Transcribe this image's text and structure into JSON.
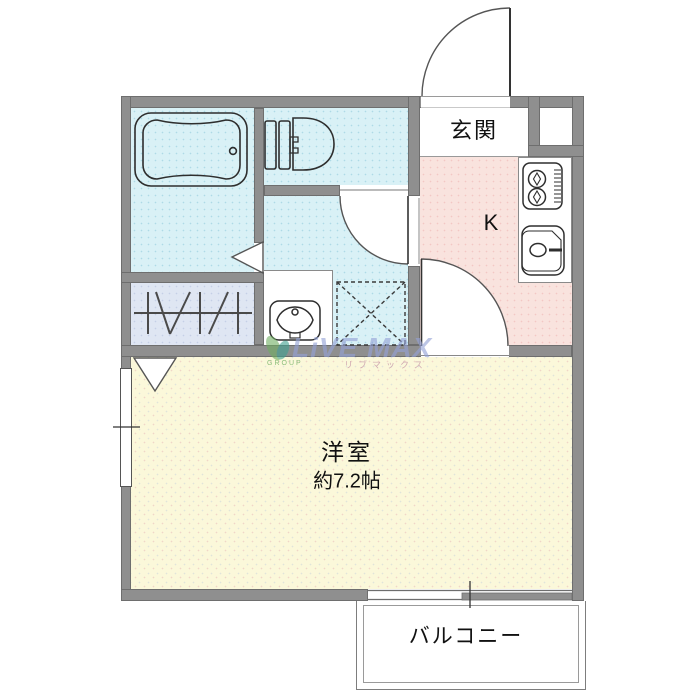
{
  "rooms": {
    "genkan": {
      "label": "玄関"
    },
    "kitchen": {
      "label": "K"
    },
    "western_room": {
      "label": "洋室",
      "area": "約7.2帖"
    },
    "balcony": {
      "label": "バルコニー"
    }
  },
  "watermark": {
    "brand": "LiVE MAX",
    "group_label": "GROUP",
    "katakana": "リブマックス",
    "logo": "leaf-logo"
  },
  "fixtures": {
    "bathtub": "bathtub-icon",
    "toilet": "toilet-icon",
    "stove": "stove-icon",
    "kitchen_sink": "kitchen-sink-icon",
    "washbasin": "washbasin-icon",
    "washing_machine_space": "washing-machine-space",
    "closet_hanger": "closet-hanger-icon",
    "window": "window-symbol",
    "sliding_door": "sliding-window-symbol",
    "doors": [
      "entrance-door-arc",
      "washroom-door-arc",
      "kitchen-door-arc",
      "bath-door-triangle",
      "closet-door-triangle"
    ]
  },
  "colors": {
    "wall": "#8f8f8f",
    "wet_area": "#d9f1f6",
    "closet": "#dfe6f3",
    "kitchen": "#f9e3de",
    "living": "#fbf8da",
    "entrance_floor": "#ffffff",
    "balcony_floor": "#ffffff",
    "line": "#444444",
    "watermark_text": "#94a2d6",
    "watermark_green": "#6fae62",
    "watermark_teal": "#3fa08f",
    "watermark_pink": "#cda3af"
  }
}
